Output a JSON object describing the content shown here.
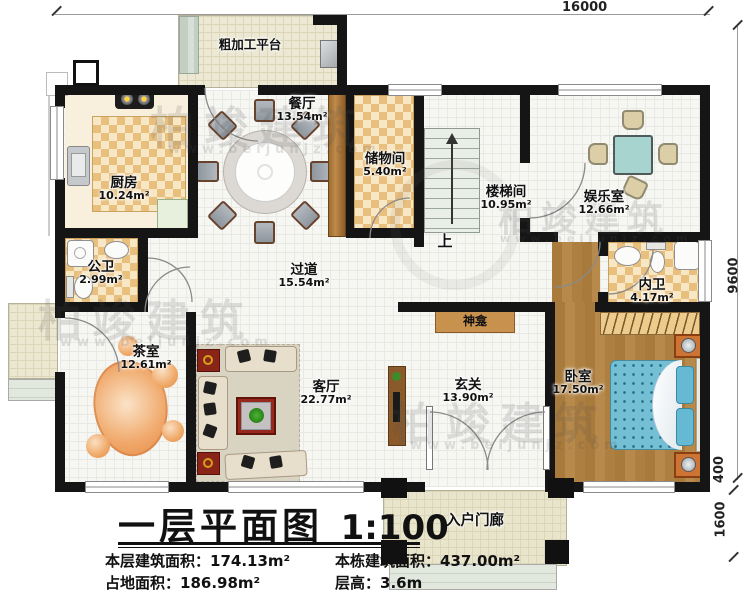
{
  "title": {
    "text": "一层平面图",
    "scale": "1:100"
  },
  "stats": {
    "floor_area_label": "本层建筑面积：",
    "floor_area_value": "174.13m²",
    "total_area_label": "本栋建筑面积：",
    "total_area_value": "437.00m²",
    "footprint_label": "占地面积：",
    "footprint_value": "186.98m²",
    "height_label": "层高：",
    "height_value": "3.6m"
  },
  "dimensions": {
    "top_width": "16000",
    "right_depth": "9600",
    "right_offset": "400",
    "porch_depth": "1600"
  },
  "rooms": [
    {
      "id": "platform",
      "name": "粗加工平台",
      "area": ""
    },
    {
      "id": "kitchen",
      "name": "厨房",
      "area": "10.24m²"
    },
    {
      "id": "dining",
      "name": "餐厅",
      "area": "13.54m²"
    },
    {
      "id": "storage",
      "name": "储物间",
      "area": "5.40m²"
    },
    {
      "id": "stairwell",
      "name": "楼梯间",
      "area": "10.95m²"
    },
    {
      "id": "entertainment",
      "name": "娱乐室",
      "area": "12.66m²"
    },
    {
      "id": "public-bath",
      "name": "公卫",
      "area": "2.99m²"
    },
    {
      "id": "corridor",
      "name": "过道",
      "area": "15.54m²"
    },
    {
      "id": "private-bath",
      "name": "内卫",
      "area": "4.17m²"
    },
    {
      "id": "tea-room",
      "name": "茶室",
      "area": "12.61m²"
    },
    {
      "id": "living-room",
      "name": "客厅",
      "area": "22.77m²"
    },
    {
      "id": "shrine",
      "name": "神龛",
      "area": ""
    },
    {
      "id": "foyer",
      "name": "玄关",
      "area": "13.90m²"
    },
    {
      "id": "bedroom",
      "name": "卧室",
      "area": "17.50m²"
    },
    {
      "id": "porch",
      "name": "入户门廊",
      "area": ""
    }
  ],
  "stairs": {
    "up_label": "上"
  },
  "watermark": {
    "brand": "柏竣建筑",
    "url": "www.beijunjz.com"
  },
  "colors": {
    "wall": "#151515",
    "checker_tile": "#e9bf7e",
    "wood_floor": "#ad7f41",
    "mattress": "#74bfd4",
    "rug_red": "#97281b",
    "shrine_shelf": "#c8914e"
  }
}
